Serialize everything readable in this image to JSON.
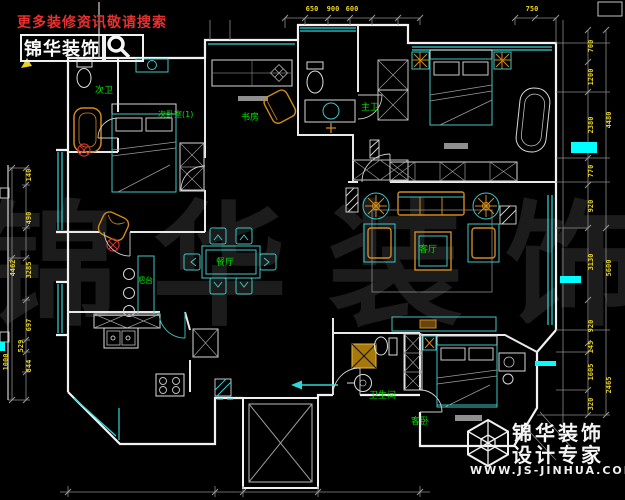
{
  "header": {
    "tagline": "更多装修资讯敬请搜索",
    "brand": "锦华装饰",
    "search_icon": "magnifier"
  },
  "footer": {
    "brand_line1": "锦华装饰",
    "brand_line2": "设计专家",
    "website": "WWW.JS-JINHUA.COM",
    "logo": "wireframe-cube"
  },
  "watermark": {
    "char1": "锦",
    "char2": "华",
    "char3": "装",
    "char4": "饰"
  },
  "plan": {
    "rooms": [
      {
        "label": "次卫"
      },
      {
        "label": "次卧室(1)"
      },
      {
        "label": "书房"
      },
      {
        "label": "主卫"
      },
      {
        "label": "客厅"
      },
      {
        "label": "餐厅"
      },
      {
        "label": "吧台"
      },
      {
        "label": "卫生间"
      },
      {
        "label": "客卧"
      }
    ],
    "dims": {
      "top": [
        "650",
        "900",
        "600",
        "750"
      ],
      "right_inner": [
        "700",
        "1200",
        "2380",
        "770",
        "920",
        "3130",
        "920",
        "145",
        "1605",
        "320"
      ],
      "right_outer": [
        "4480",
        "5600",
        "2465"
      ],
      "left_inner": [
        "140",
        "490",
        "3285",
        "697",
        "529",
        "844"
      ],
      "left_outer": [
        "4462",
        "1000"
      ]
    },
    "colors": {
      "background": "#000000",
      "wall_white": "#f2f2f2",
      "furniture_cyan": "#3fc6c6",
      "window_cyan": "#2fd8d8",
      "dimension_yellow": "#e8d21f",
      "label_green": "#00e400",
      "accent_orange": "#cf8a1d",
      "brand_red": "#e83030",
      "highlight_cyan": "#00ffff",
      "watermark_gray": "#1c1c1c"
    }
  }
}
